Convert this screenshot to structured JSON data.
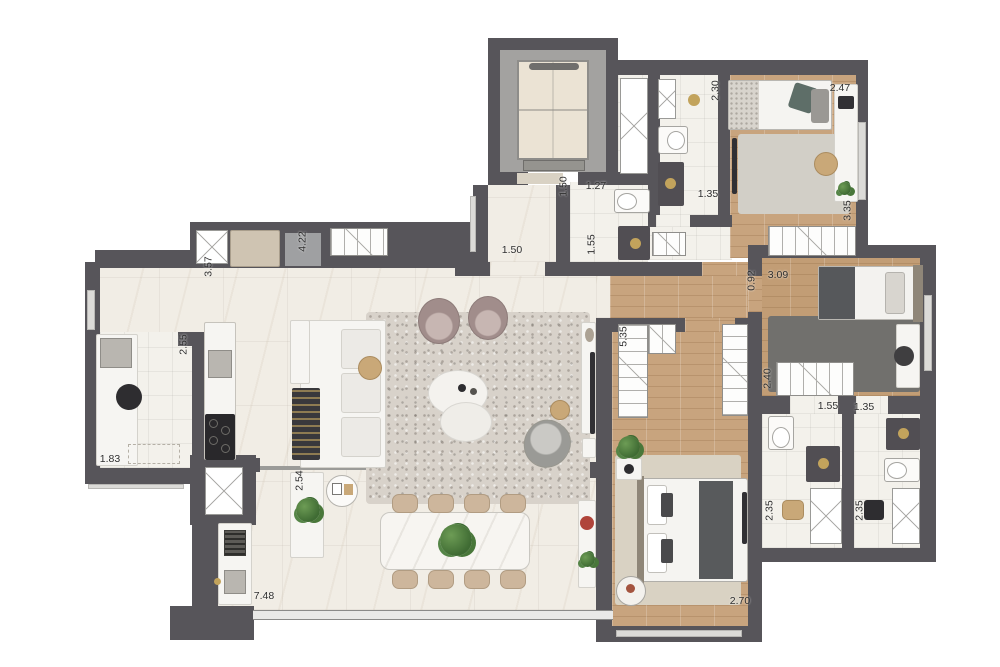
{
  "meta": {
    "type": "apartment-floor-plan",
    "units": "meters"
  },
  "colors": {
    "wall": "#57555a",
    "floor_marble": "#f1ede5",
    "floor_tile": "#f3f1eb",
    "floor_wood": "#c8a47e",
    "elevator_shaft": "#a3a2a0",
    "appliance_dark": "#313034",
    "accent_gold": "#c2a35c",
    "rug_dark": "#71706d",
    "rug_beige": "#d9d2c3"
  },
  "dims": {
    "kitchen_depth": "3.57",
    "kitchen_run": "4.22",
    "hall_width": "1.50",
    "hall_depth": "1.50",
    "lavabo_width": "1.27",
    "lavabo_depth": "1.55",
    "bath1_depth": "2.30",
    "bed1_width": "2.47",
    "bath1_width": "1.35",
    "bed1_depth": "3.35",
    "corridor_width": "0.92",
    "bed2_width": "3.09",
    "closet_depth": "5.35",
    "bed2_wardrobe": "2.40",
    "bath2_width": "1.55",
    "bath3_width": "1.35",
    "bath2_depth": "2.35",
    "bath3_depth": "2.35",
    "master_width": "2.70",
    "laundry_depth": "2.55",
    "laundry_width": "1.83",
    "buffet_length": "2.54",
    "terrace_width": "7.48"
  }
}
